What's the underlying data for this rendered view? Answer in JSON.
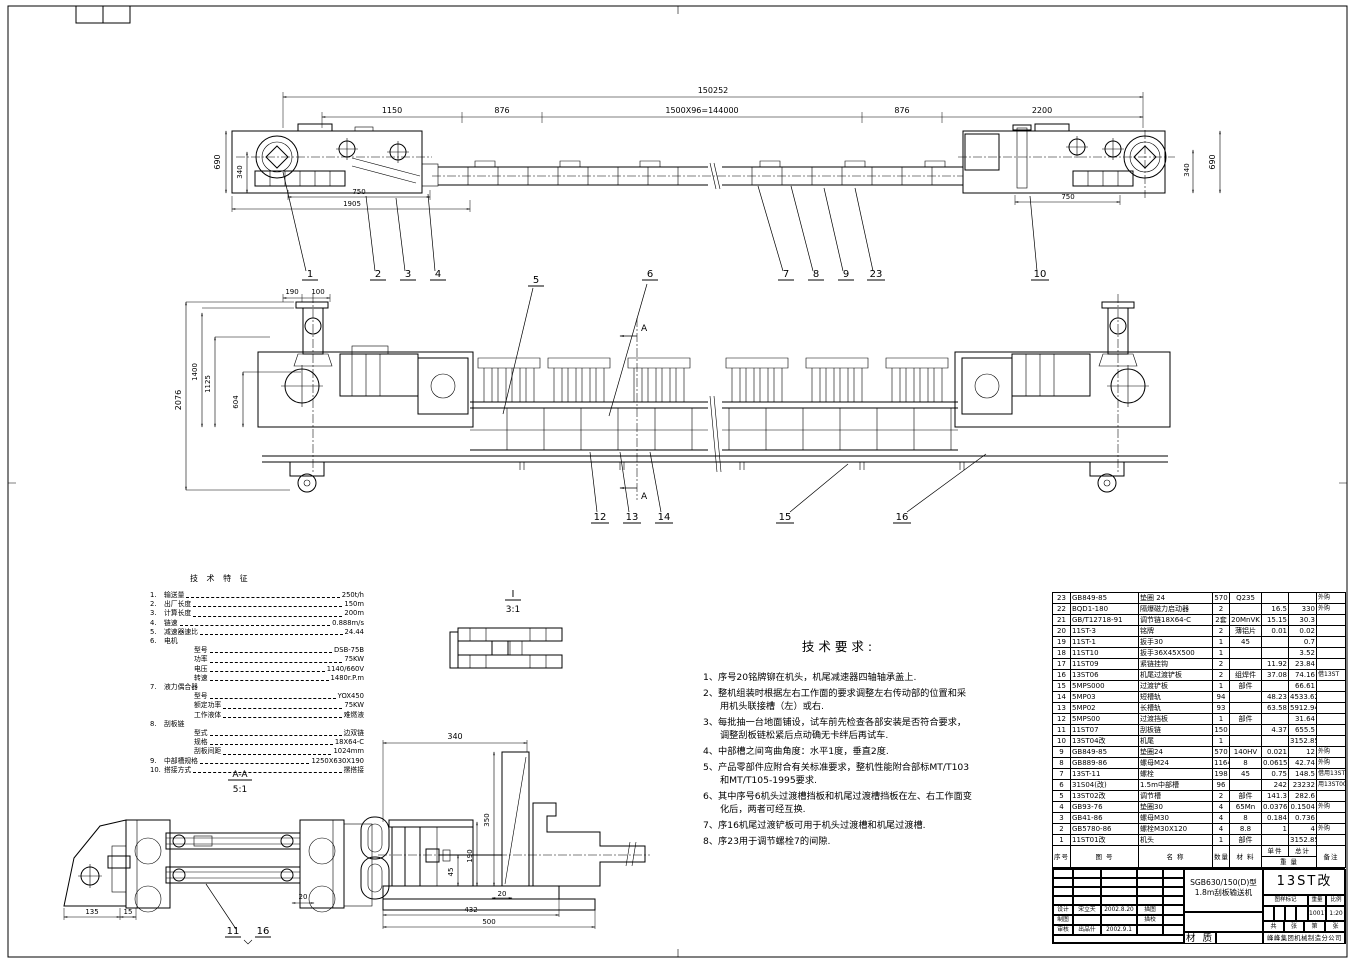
{
  "tech_features": {
    "title": "技 术 特 征",
    "lines": [
      {
        "no": "1.",
        "name": "输送量",
        "value": "250t/h",
        "indent": 0
      },
      {
        "no": "2.",
        "name": "出厂长度",
        "value": "150m",
        "indent": 0
      },
      {
        "no": "3.",
        "name": "计算长度",
        "value": "200m",
        "indent": 0
      },
      {
        "no": "4.",
        "name": "链速",
        "value": "0.888m/s",
        "indent": 0
      },
      {
        "no": "5.",
        "name": "减速器速比",
        "value": "24.44",
        "indent": 0
      },
      {
        "no": "6.",
        "name": "电机",
        "value": "",
        "indent": 0
      },
      {
        "no": "",
        "name": "型号",
        "value": "DSB-75B",
        "indent": 1
      },
      {
        "no": "",
        "name": "功率",
        "value": "75KW",
        "indent": 1
      },
      {
        "no": "",
        "name": "电压",
        "value": "1140/660V",
        "indent": 1
      },
      {
        "no": "",
        "name": "转速",
        "value": "1480r.P.m",
        "indent": 1
      },
      {
        "no": "7.",
        "name": "液力偶合器",
        "value": "",
        "indent": 0
      },
      {
        "no": "",
        "name": "型号",
        "value": "YOX450",
        "indent": 1
      },
      {
        "no": "",
        "name": "额定功率",
        "value": "75KW",
        "indent": 1
      },
      {
        "no": "",
        "name": "工作液体",
        "value": "难燃液",
        "indent": 1
      },
      {
        "no": "8.",
        "name": "刮板链",
        "value": "",
        "indent": 0
      },
      {
        "no": "",
        "name": "型式",
        "value": "边双链",
        "indent": 1
      },
      {
        "no": "",
        "name": "规格",
        "value": "18X64-C",
        "indent": 1
      },
      {
        "no": "",
        "name": "刮板间距",
        "value": "1024mm",
        "indent": 1
      },
      {
        "no": "9.",
        "name": "中部槽规格",
        "value": "1250X630X190",
        "indent": 0
      },
      {
        "no": "10.",
        "name": "搭接方式",
        "value": "摞搭接",
        "indent": 0
      }
    ]
  },
  "tech_requirements": {
    "title": "技术要求:",
    "items": [
      "1、序号20铭牌铆在机头，机尾减速器四轴轴承盖上.",
      "2、整机组装时根据左右工作面的要求调整左右传动部的位置和采用机头联接槽（左）或右.",
      "3、每批抽一台地面铺设，试车前先检查各部安装是否符合要求，调整刮板链松紧后点动确无卡绊后再试车.",
      "4、中部槽之间弯曲角度：水平1度，垂直2度.",
      "5、产品零部件应附合有关标准要求，整机性能附合部标MT/T103和MT/T105-1995要求.",
      "6、其中序号6机头过渡槽挡板和机尾过渡槽挡板在左、右工作面变化后，两者可经互换.",
      "7、序16机尾过渡铲板可用于机头过渡槽和机尾过渡槽.",
      "8、序23用于调节螺栓7的间隙."
    ]
  },
  "parts_table": {
    "headers": {
      "no": "序号",
      "code": "图  号",
      "name": "名  称",
      "qty": "数量",
      "material": "材 料",
      "unit": "单件",
      "total": "总计",
      "weight": "重  量",
      "remark": "备注"
    },
    "rows": [
      [
        "23",
        "GB849-85",
        "垫圈 24",
        "570",
        "Q235",
        "",
        "",
        "外购"
      ],
      [
        "22",
        "BQD1-180",
        "隔爆磁力启动器",
        "2",
        "",
        "16.5",
        "330",
        "外购"
      ],
      [
        "21",
        "GB/T12718-91",
        "调节链18X64-C",
        "2套",
        "20MnVK",
        "15.15",
        "30.3",
        ""
      ],
      [
        "20",
        "11ST-3",
        "铭牌",
        "2",
        "薄铝片",
        "0.01",
        "0.02",
        ""
      ],
      [
        "19",
        "11ST-1",
        "扳手30",
        "1",
        "45",
        "",
        "0.7",
        ""
      ],
      [
        "18",
        "11ST10",
        "扳手36X45X500",
        "1",
        "",
        "",
        "3.52",
        ""
      ],
      [
        "17",
        "11ST09",
        "紧链挂钩",
        "2",
        "",
        "11.92",
        "23.84",
        ""
      ],
      [
        "16",
        "13ST06",
        "机尾过渡铲板",
        "2",
        "组焊件",
        "37.08",
        "74.16",
        "借13ST"
      ],
      [
        "15",
        "5MPS000",
        "过渡铲板",
        "1",
        "部件",
        "",
        "66.61",
        ""
      ],
      [
        "14",
        "5MP03",
        "短槽轨",
        "94",
        "",
        "48.23",
        "4533.62",
        ""
      ],
      [
        "13",
        "5MP02",
        "长槽轨",
        "93",
        "",
        "63.58",
        "5912.94",
        ""
      ],
      [
        "12",
        "5MPS00",
        "过渡挡板",
        "1",
        "部件",
        "",
        "31.64",
        ""
      ],
      [
        "11",
        "11ST07",
        "刮板链",
        "150",
        "",
        "4.37",
        "655.5",
        ""
      ],
      [
        "10",
        "13ST04改",
        "机尾",
        "1",
        "",
        "",
        "3152.85",
        ""
      ],
      [
        "9",
        "GB849-85",
        "垫圈24",
        "570",
        "140HV",
        "0.021",
        "12",
        "外购"
      ],
      [
        "8",
        "GB889-86",
        "螺母M24",
        "1164",
        "8",
        "0.0615",
        "42.74",
        "外购"
      ],
      [
        "7",
        "13ST-11",
        "螺栓",
        "198",
        "45",
        "0.75",
        "148.5",
        "借用13ST"
      ],
      [
        "6",
        "31S04(改)",
        "1.5m中部槽",
        "96",
        "",
        "242",
        "23232",
        "用13ST00改"
      ],
      [
        "5",
        "13ST02改",
        "调节槽",
        "2",
        "部件",
        "141.3",
        "282.6",
        ""
      ],
      [
        "4",
        "GB93-76",
        "垫圈30",
        "4",
        "65Mn",
        "0.0376",
        "0.1504",
        "外购"
      ],
      [
        "3",
        "GB41-86",
        "螺母M30",
        "4",
        "8",
        "0.184",
        "0.736",
        ""
      ],
      [
        "2",
        "GB5780-86",
        "螺栓M30X120",
        "4",
        "8.8",
        "1",
        "4",
        "外购"
      ],
      [
        "1",
        "11ST01改",
        "机头",
        "1",
        "部件",
        "",
        "3152.85",
        ""
      ]
    ]
  },
  "title_block": {
    "product_model": "SGB630/150(D)型",
    "product_name": "1.8m刮板输送机",
    "drawing_no": "13ST改",
    "mark_header": [
      "图样标记",
      "重量",
      "比例"
    ],
    "weight_value": "10017",
    "scale_value": "1:20",
    "sheet_row": [
      "共",
      "张",
      "第",
      "张"
    ],
    "company": "峰峰集团机械制造分公司",
    "material_label": "材 质",
    "sign_rows": [
      {
        "role": "设计",
        "name": "宋立天",
        "date": "2002.8.20",
        "right": "描图"
      },
      {
        "role": "制图",
        "name": "",
        "date": "",
        "right": "描校"
      },
      {
        "role": "审核",
        "name": "出品什",
        "date": "2002.9.1",
        "right": ""
      }
    ]
  },
  "views": {
    "top": {
      "dim_overall": "150252",
      "dim_segments": [
        "1150",
        "876",
        "1500X96=144000",
        "876",
        "2200"
      ],
      "dim_left_height": "690",
      "dim_left_inner": "340",
      "dim_left_bottom": [
        "750",
        "1905"
      ],
      "dim_right_inner": "340",
      "dim_right_height": "690",
      "dim_right_bottom": "750",
      "balloons": [
        "1",
        "2",
        "3",
        "4",
        "5",
        "6",
        "7",
        "8",
        "9",
        "23",
        "10"
      ]
    },
    "middle": {
      "dim_left": [
        "2076",
        "1400",
        "1125",
        "604"
      ],
      "dim_top": [
        "190",
        "100"
      ],
      "balloons": [
        "12",
        "13",
        "14",
        "15",
        "16"
      ],
      "section_mark": "A"
    },
    "section_large": {
      "dims": [
        "340",
        "350",
        "190",
        "45",
        "20",
        "432",
        "500"
      ]
    },
    "section_small": {
      "title": "A-A",
      "scale": "5:1",
      "dims": [
        "135",
        "15",
        "20"
      ],
      "balloons": [
        "11",
        "16"
      ]
    },
    "detail": {
      "title": "I",
      "scale": "3:1"
    }
  }
}
